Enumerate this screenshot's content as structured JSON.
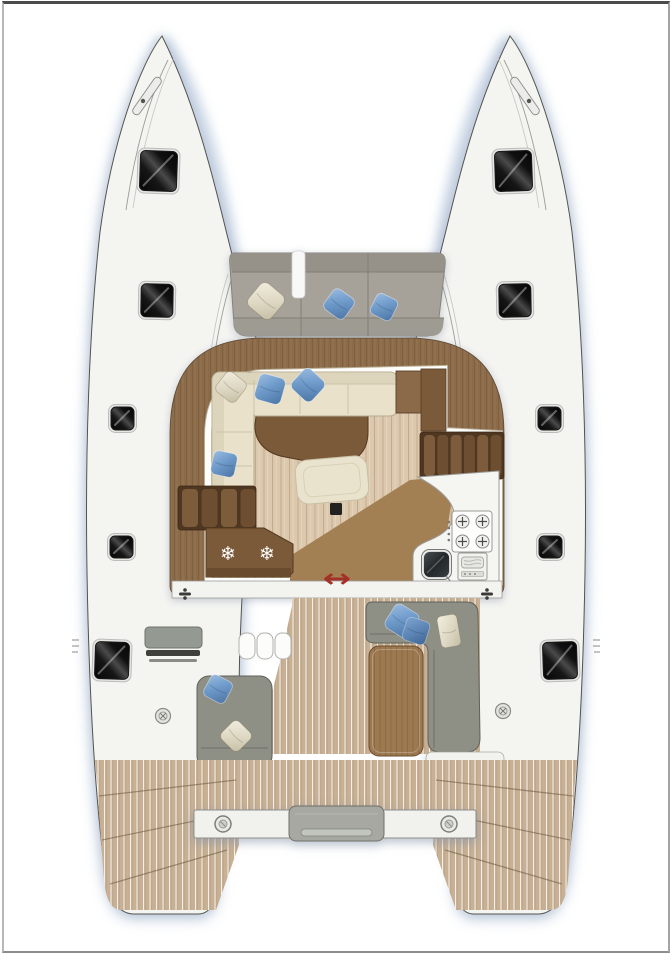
{
  "plan": {
    "kind": "catamaran-deck-and-saloon-floor-plan",
    "visible_text": "",
    "regions": [
      "port-hull",
      "starboard-hull",
      "trampoline-foredeck",
      "foredeck-sofa",
      "saloon",
      "saloon-sofa",
      "saloon-table",
      "ottoman",
      "chart-table",
      "port-stairs",
      "starboard-stairs",
      "fridge-counter",
      "galley-counter",
      "stove",
      "sink",
      "oven",
      "sliding-door",
      "cockpit",
      "cockpit-bench",
      "cockpit-steps",
      "sun-lounger",
      "cockpit-sofa",
      "cockpit-table",
      "aft-crossbeam",
      "dinghy-platform",
      "port-transom-steps",
      "starboard-transom-steps"
    ]
  },
  "salon": {
    "fridge": {
      "snowflake_glyph": "❄",
      "count": 2
    },
    "door": {
      "arrow_glyph": "↔"
    }
  },
  "colors": {
    "hullFill": "#f4f4f1",
    "hullLine": "#54544f",
    "teak": "#c7b094",
    "floorTan": "#dcc8ac",
    "deckBrown": "#8c6b49",
    "darkWood": "#7b5a3a",
    "darkWood2": "#6a4b2e",
    "slat": "#7d5c3b",
    "cushionGray": "#a6a29a",
    "cushionGrayDark": "#96928a",
    "sofaGray": "#8e9086",
    "sofaGrayLine": "#6e706a",
    "cream": "#eae1cb",
    "blue": "#7fa6d4",
    "blueDark": "#4b749f",
    "tableWood": "#9d7950",
    "arrowRed": "#a33127"
  },
  "hatches": [
    {
      "side": "port",
      "x": 140,
      "y": 151,
      "w": 37,
      "h": 40,
      "rot": 2
    },
    {
      "side": "port",
      "x": 141,
      "y": 284,
      "w": 32,
      "h": 33,
      "rot": 1
    },
    {
      "side": "port",
      "x": 111,
      "y": 407,
      "w": 23,
      "h": 23,
      "rot": 0
    },
    {
      "side": "port",
      "x": 110,
      "y": 536,
      "w": 23,
      "h": 22,
      "rot": 0
    },
    {
      "side": "port",
      "x": 95,
      "y": 642,
      "w": 34,
      "h": 37,
      "rot": 2
    },
    {
      "side": "starboard",
      "x": 495,
      "y": 151,
      "w": 37,
      "h": 40,
      "rot": -2
    },
    {
      "side": "starboard",
      "x": 499,
      "y": 284,
      "w": 32,
      "h": 33,
      "rot": -1
    },
    {
      "side": "starboard",
      "x": 538,
      "y": 407,
      "w": 23,
      "h": 23,
      "rot": 0
    },
    {
      "side": "starboard",
      "x": 539,
      "y": 536,
      "w": 23,
      "h": 22,
      "rot": 0
    },
    {
      "side": "starboard",
      "x": 543,
      "y": 642,
      "w": 34,
      "h": 37,
      "rot": -2
    }
  ],
  "pillows": [
    {
      "area": "foredeck",
      "color": "cream",
      "cx": 266,
      "cy": 301,
      "size": 30,
      "rot": 40
    },
    {
      "area": "foredeck",
      "color": "blue",
      "cx": 339,
      "cy": 304,
      "size": 25,
      "rot": 36
    },
    {
      "area": "foredeck",
      "color": "blue",
      "cx": 384,
      "cy": 307,
      "size": 23,
      "rot": 26
    },
    {
      "area": "saloon",
      "color": "cream",
      "cx": 231,
      "cy": 387,
      "size": 25,
      "rot": 38
    },
    {
      "area": "saloon",
      "color": "blue",
      "cx": 270,
      "cy": 389,
      "size": 27,
      "rot": 16
    },
    {
      "area": "saloon",
      "color": "blue",
      "cx": 308,
      "cy": 385,
      "size": 27,
      "rot": 43
    },
    {
      "area": "saloon",
      "color": "blue",
      "cx": 224,
      "cy": 464,
      "size": 24,
      "rot": 12
    },
    {
      "area": "lounger",
      "color": "blue",
      "cx": 218,
      "cy": 689,
      "size": 24,
      "rot": 28
    },
    {
      "area": "lounger",
      "color": "cream",
      "cx": 236,
      "cy": 736,
      "size": 25,
      "rot": 45
    },
    {
      "area": "cockpit-sofa",
      "color": "blue",
      "cx": 402,
      "cy": 621,
      "size": 28,
      "rot": 32
    },
    {
      "area": "cockpit-sofa",
      "color": "blue2",
      "cx": 416,
      "cy": 631,
      "size": 24,
      "rot": 18
    },
    {
      "area": "cockpit-sofa",
      "color": "cream",
      "cx": 449,
      "cy": 631,
      "w": 20,
      "h": 32,
      "rot": -10
    }
  ]
}
